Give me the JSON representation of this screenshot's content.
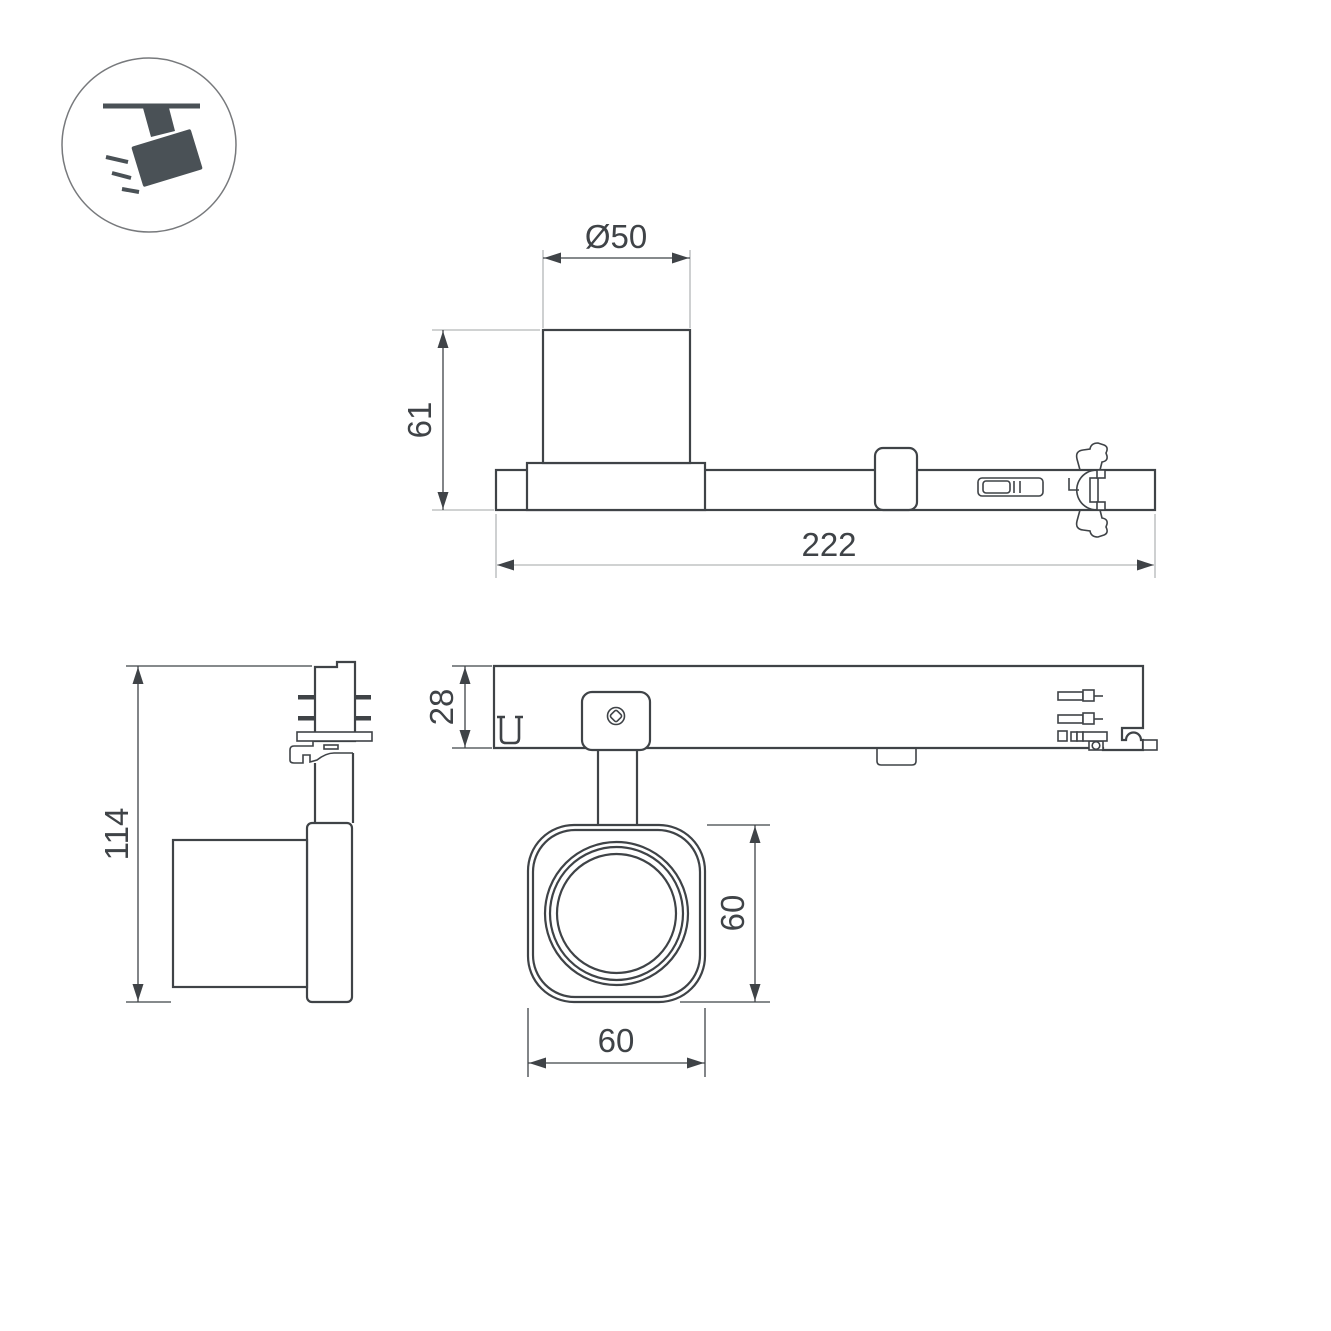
{
  "drawing": {
    "type": "technical-dimension-drawing",
    "subject": "track-spotlight-luminaire",
    "colors": {
      "background": "#ffffff",
      "line": "#3f4347",
      "extension_line": "#b4b6b8",
      "icon": "#4a5156"
    },
    "corner_icon": {
      "name": "track-spotlight-icon"
    },
    "views": {
      "top": {
        "dim_diameter": "Ø50",
        "dim_height": "61",
        "dim_length": "222"
      },
      "front": {
        "dim_track_height": "28",
        "dim_head_height": "60",
        "dim_head_width": "60"
      },
      "side": {
        "dim_total_height": "114"
      }
    }
  }
}
